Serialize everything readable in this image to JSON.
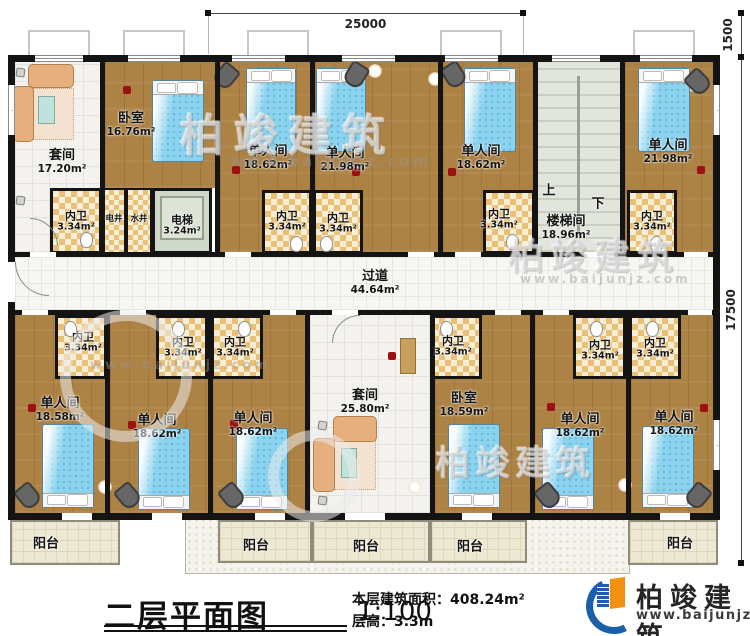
{
  "title_block": {
    "plan_title": "二层平面图",
    "scale": "1:100",
    "area_label": "本层建筑面积：",
    "area_value": "408.24m²",
    "height_label": "层高：",
    "height_value": "3.3m"
  },
  "brand": {
    "name": "柏竣建筑",
    "website": "www.baijunjz.com"
  },
  "dims": {
    "width": "25000",
    "right_upper": "1500",
    "right_main": "17500"
  },
  "corridor": {
    "name": "过道",
    "area": "44.64m²"
  },
  "stair": {
    "up": "上",
    "down": "下"
  },
  "top_rooms": [
    {
      "name": "套间",
      "area": "17.20m²"
    },
    {
      "name": "卧室",
      "area": "16.76m²"
    },
    {
      "name": "单人间",
      "area": "18.62m²"
    },
    {
      "name": "单人间",
      "area": "21.98m²"
    },
    {
      "name": "单人间",
      "area": "18.62m²"
    },
    {
      "name": "楼梯间",
      "area": "18.96m²"
    },
    {
      "name": "单人间",
      "area": "21.98m²"
    }
  ],
  "top_cells": [
    {
      "name": "内卫",
      "area": "3.34m²"
    },
    {
      "name": "电井"
    },
    {
      "name": "水井"
    },
    {
      "name": "电梯",
      "area": "3.24m²"
    },
    {
      "name": "内卫",
      "area": "3.34m²"
    },
    {
      "name": "内卫",
      "area": "3.34m²"
    },
    {
      "name": "内卫",
      "area": "3.34m²"
    },
    {
      "name": "内卫",
      "area": "3.34m²"
    }
  ],
  "bottom_cells": [
    {
      "name": "内卫",
      "area": "3.34m²"
    },
    {
      "name": "内卫",
      "area": "3.34m²"
    },
    {
      "name": "内卫",
      "area": "3.34m²"
    },
    {
      "name": "内卫",
      "area": "3.34m²"
    },
    {
      "name": "内卫",
      "area": "3.34m²"
    },
    {
      "name": "内卫",
      "area": "3.34m²"
    }
  ],
  "bottom_rooms": [
    {
      "name": "单人间",
      "area": "18.58m²"
    },
    {
      "name": "单人间",
      "area": "18.62m²"
    },
    {
      "name": "单人间",
      "area": "18.62m²"
    },
    {
      "name": "套间",
      "area": "25.80m²"
    },
    {
      "name": "卧室",
      "area": "18.59m²"
    },
    {
      "name": "单人间",
      "area": "18.62m²"
    },
    {
      "name": "单人间",
      "area": "18.62m²"
    }
  ],
  "balconies": [
    {
      "name": "阳台"
    },
    {
      "name": "阳台"
    },
    {
      "name": "阳台"
    },
    {
      "name": "阳台"
    },
    {
      "name": "阳台"
    }
  ]
}
